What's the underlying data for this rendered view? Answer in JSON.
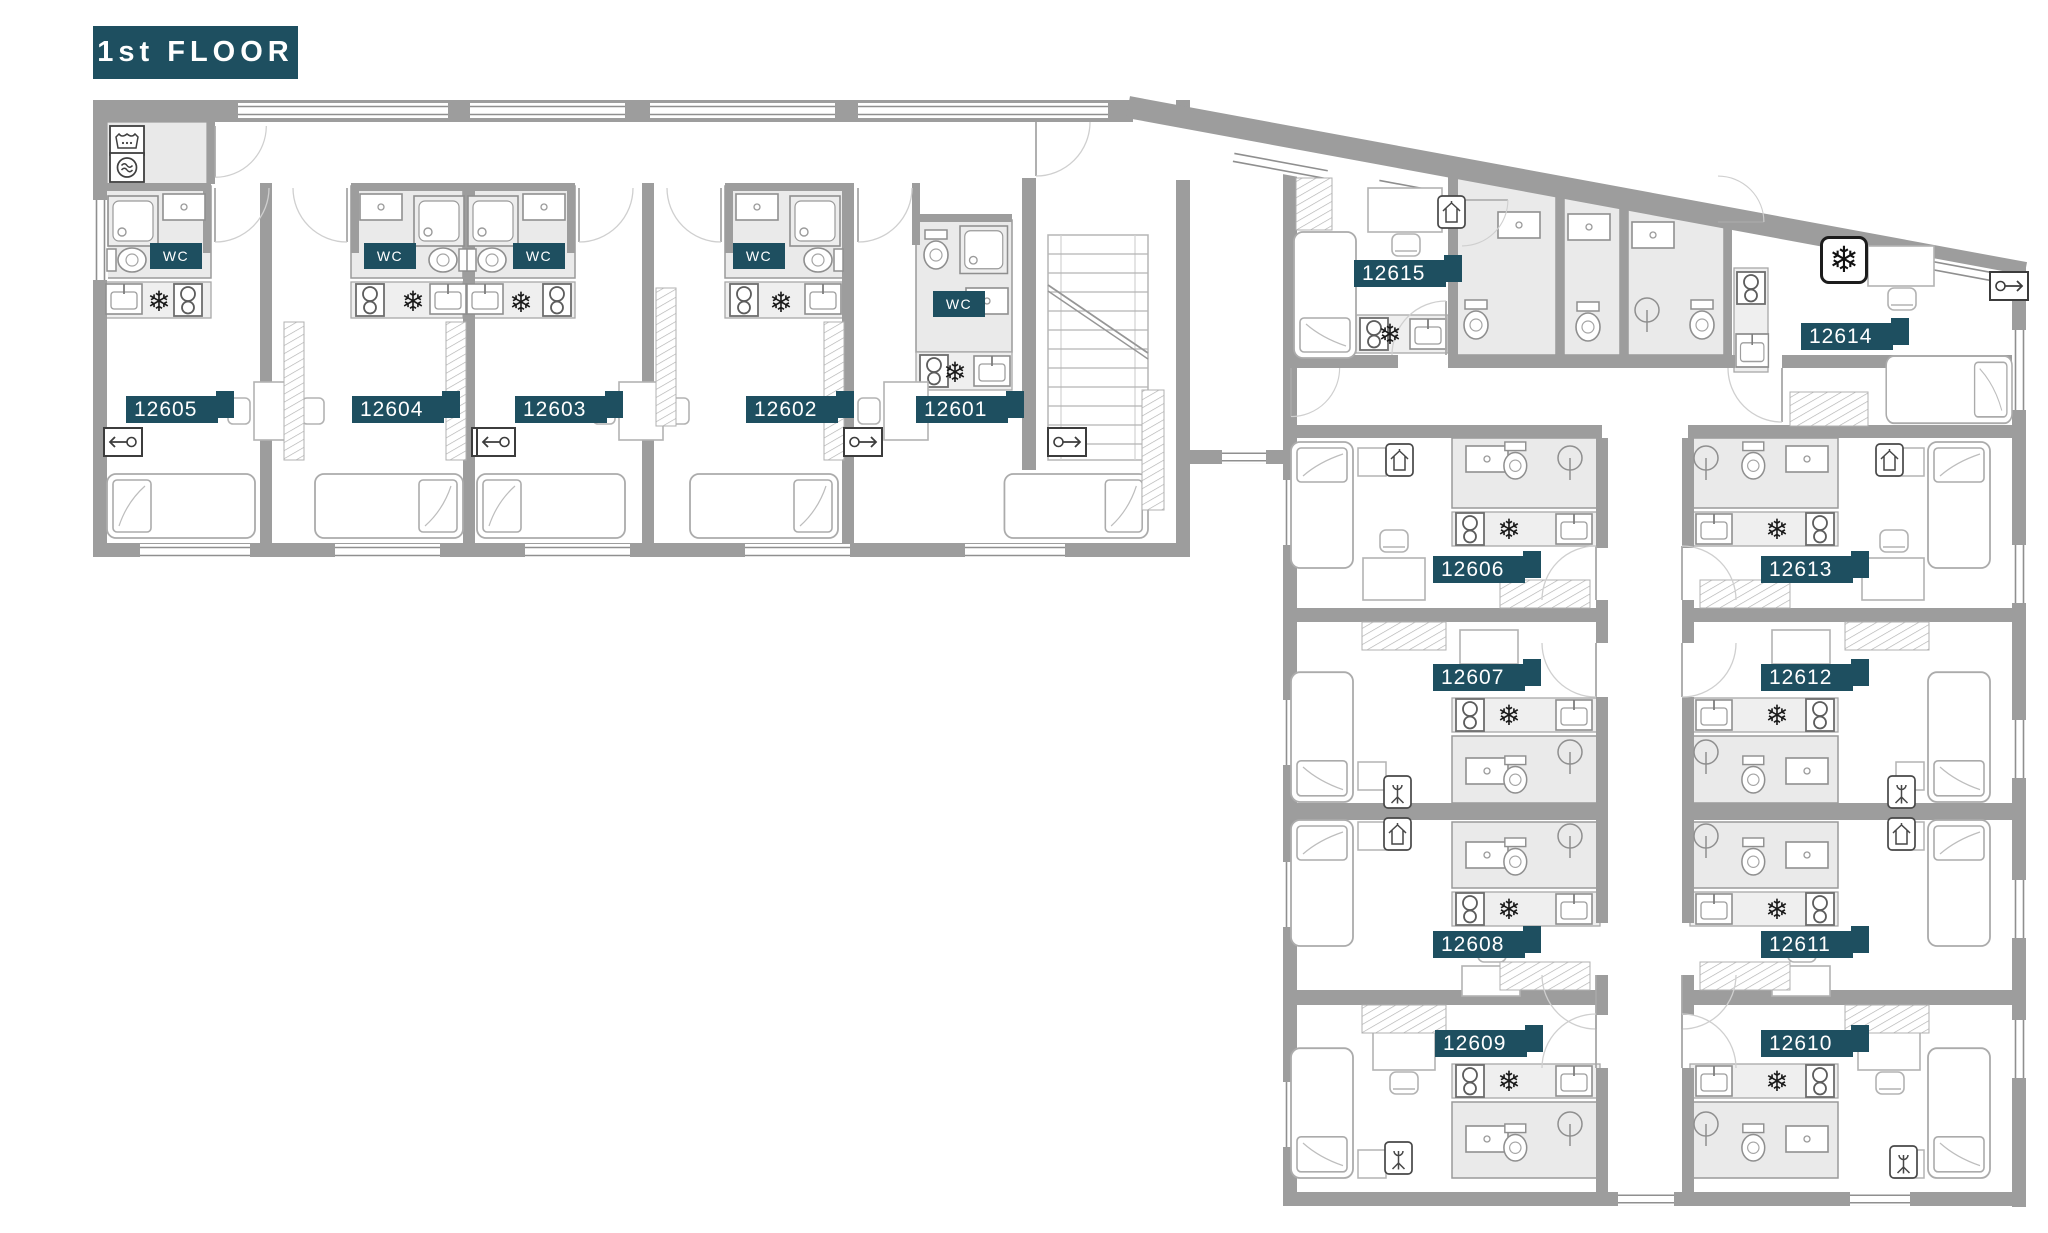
{
  "title": "1st FLOOR",
  "labels": {
    "wc": "WC"
  },
  "icons": {
    "snowflake": "❄"
  },
  "colors": {
    "accent_teal": "#1E4F60",
    "wall_gray": "#9D9D9D",
    "bathroom_gray": "#EAEAEA"
  },
  "rooms": [
    {
      "id": "12605",
      "label": "12605"
    },
    {
      "id": "12604",
      "label": "12604"
    },
    {
      "id": "12603",
      "label": "12603"
    },
    {
      "id": "12602",
      "label": "12602"
    },
    {
      "id": "12601",
      "label": "12601"
    },
    {
      "id": "12606",
      "label": "12606"
    },
    {
      "id": "12607",
      "label": "12607"
    },
    {
      "id": "12608",
      "label": "12608"
    },
    {
      "id": "12609",
      "label": "12609"
    },
    {
      "id": "12610",
      "label": "12610"
    },
    {
      "id": "12611",
      "label": "12611"
    },
    {
      "id": "12612",
      "label": "12612"
    },
    {
      "id": "12613",
      "label": "12613"
    },
    {
      "id": "12614",
      "label": "12614"
    },
    {
      "id": "12615",
      "label": "12615"
    }
  ]
}
